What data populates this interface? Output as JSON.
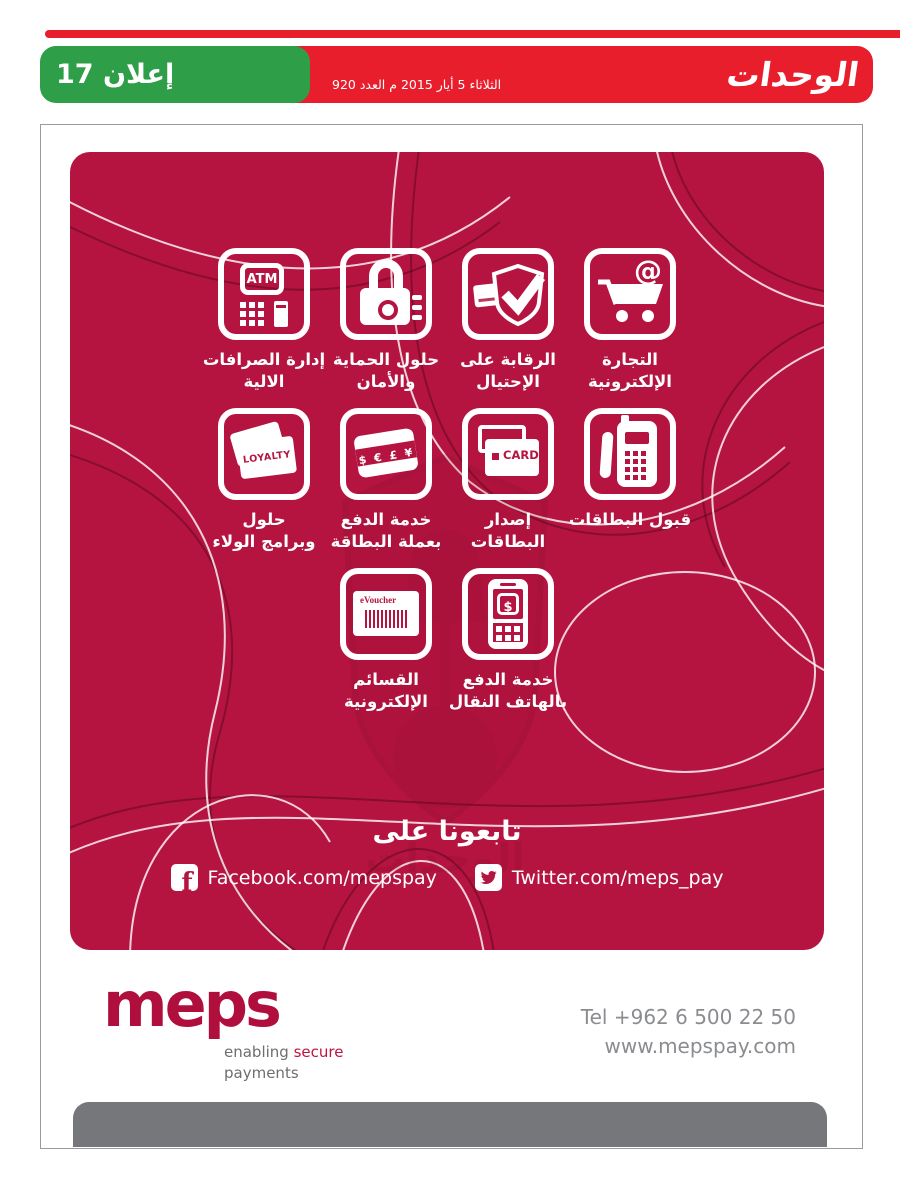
{
  "masthead": {
    "title": "الوحدات",
    "date_line": "الثلاثاء 5 أيار 2015 م العدد 920",
    "badge_label": "إعلان 17",
    "bar_color": "#e81e2c",
    "badge_color": "#2f9e48"
  },
  "ad": {
    "bg_color": "#b51440",
    "services": [
      {
        "id": "atm",
        "label_l1": "إدارة الصرافات",
        "label_l2": "الالية",
        "icon_text": "ATM"
      },
      {
        "id": "security",
        "label_l1": "حلول الحماية",
        "label_l2": "والأمان",
        "icon_text": ""
      },
      {
        "id": "fraud",
        "label_l1": "الرقابة على",
        "label_l2": "الإحتيال",
        "icon_text": ""
      },
      {
        "id": "ecommerce",
        "label_l1": "التجارة",
        "label_l2": "الإلكترونية",
        "icon_text": "@"
      },
      {
        "id": "loyalty",
        "label_l1": "حلول",
        "label_l2": "وبرامج الولاء",
        "icon_text": "LOYALTY"
      },
      {
        "id": "currency",
        "label_l1": "خدمة الدفع",
        "label_l2": "بعملة البطاقة",
        "icon_text": "$ € £ ¥"
      },
      {
        "id": "card-issue",
        "label_l1": "إصدار",
        "label_l2": "البطاقات",
        "icon_text": "CARD"
      },
      {
        "id": "pos",
        "label_l1": "قبول البطاقات",
        "label_l2": "",
        "icon_text": ""
      },
      {
        "id": "evoucher",
        "label_l1": "القسائم",
        "label_l2": "الإلكترونية",
        "icon_text": "eVoucher"
      },
      {
        "id": "mobile-pay",
        "label_l1": "خدمة الدفع",
        "label_l2": "بالهاتف النقال",
        "icon_text": "$"
      }
    ],
    "follow": {
      "heading": "تابعونا على",
      "facebook": "Facebook.com/mepspay",
      "twitter": "Twitter.com/meps_pay"
    },
    "watermark_text": "الوحدات"
  },
  "footer": {
    "logo": "meps",
    "tagline_word1": "enabling",
    "tagline_accent": "secure",
    "tagline_word2": "payments",
    "tel": "Tel +962 6 500 22 50",
    "website": "www.mepspay.com"
  }
}
